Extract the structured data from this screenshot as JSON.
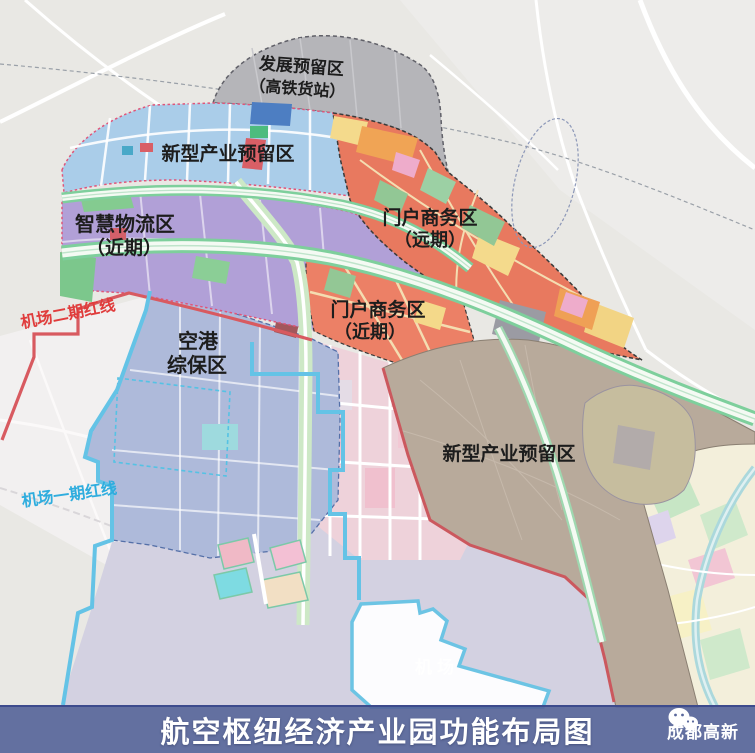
{
  "map": {
    "zones": [
      {
        "name": "development-reserve",
        "label": "发展预留区",
        "sublabel": "（高铁货站）",
        "color": "#b5b5b9"
      },
      {
        "name": "new-industry-north",
        "label": "新型产业预留区",
        "sublabel": "",
        "color": "#aacde9"
      },
      {
        "name": "smart-logistics",
        "label": "智慧物流区",
        "sublabel": "（近期）",
        "color": "#b1a0d7"
      },
      {
        "name": "gateway-business-far",
        "label": "门户商务区",
        "sublabel": "（远期）",
        "color": "#e8795f"
      },
      {
        "name": "gateway-business-near",
        "label": "门户商务区",
        "sublabel": "（近期）",
        "color": "#ec8066"
      },
      {
        "name": "airport-bonded",
        "label": "空港",
        "sublabel": "综保区",
        "color": "#aebada"
      },
      {
        "name": "new-industry-south",
        "label": "新型产业预留区",
        "sublabel": "",
        "color": "#b8aa9b"
      }
    ],
    "redlines": [
      {
        "name": "airport-phase2-redline",
        "label": "机场二期红线",
        "line_color": "#d85a60",
        "label_color": "#e03c3c"
      },
      {
        "name": "airport-phase1-redline",
        "label": "机场一期红线",
        "line_color": "#64c3e6",
        "label_color": "#2fadde"
      }
    ],
    "watermark": {
      "label": "机场"
    }
  },
  "banner": {
    "title": "航空枢纽经济产业园功能布局图",
    "brand": "成都高新",
    "background": "#505e96"
  }
}
